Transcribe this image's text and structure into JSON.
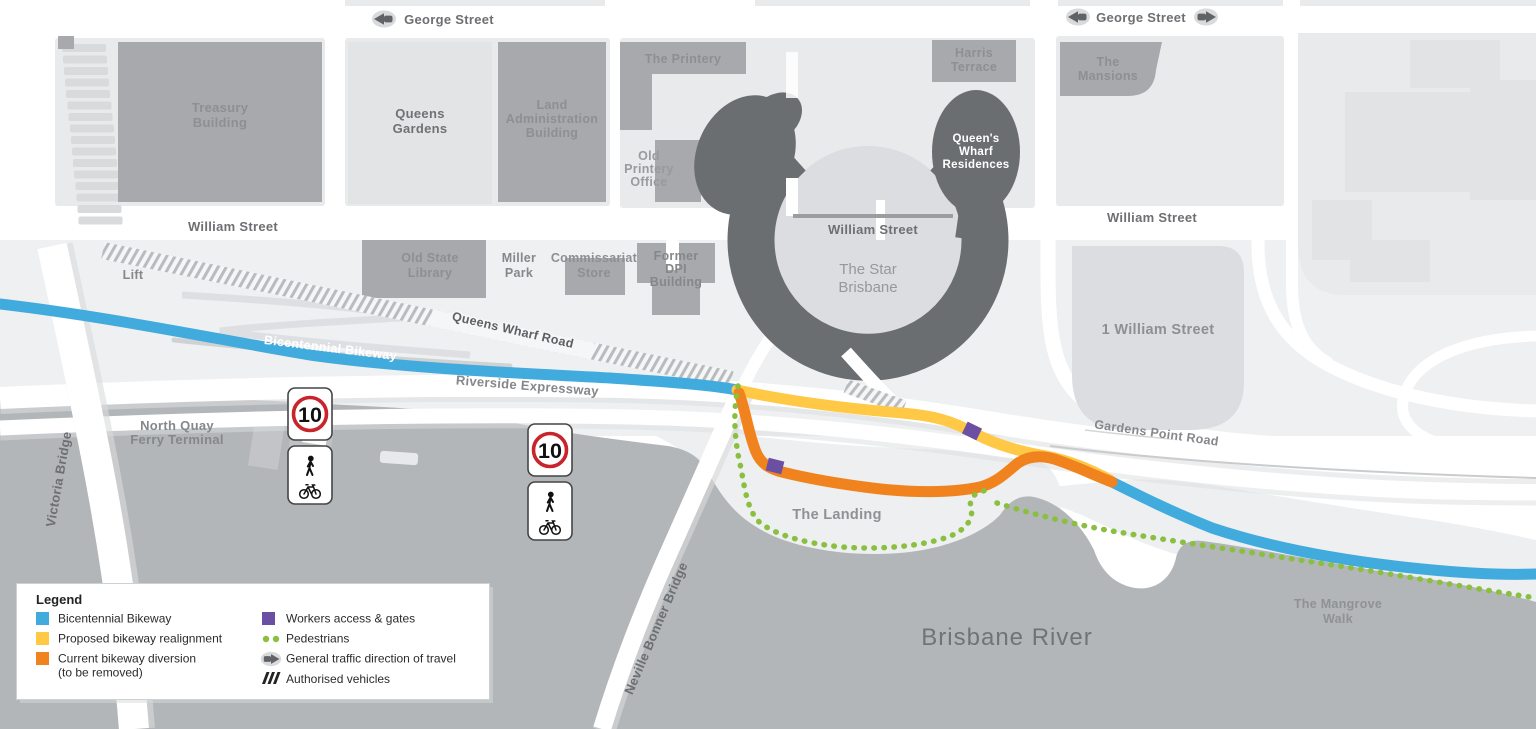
{
  "streets": {
    "george": "George Street",
    "william": "William Street",
    "queens_wharf_road": "Queens Wharf Road",
    "riverside_expressway": "Riverside Expressway",
    "gardens_point_road": "Gardens Point Road",
    "victoria_bridge": "Victoria Bridge",
    "neville_bonner_bridge": "Neville Bonner Bridge"
  },
  "routes": {
    "bicentennial_bikeway_label": "Bicentennial Bikeway"
  },
  "places": {
    "treasury": [
      "Treasury",
      "Building"
    ],
    "queens_gardens": [
      "Queens",
      "Gardens"
    ],
    "land_administration": [
      "Land",
      "Administration",
      "Building"
    ],
    "the_printery": [
      "The Printery"
    ],
    "old_printery_office": [
      "Old",
      "Printery",
      "Office"
    ],
    "harris_terrace": [
      "Harris",
      "Terrace"
    ],
    "queens_wharf_residences": [
      "Queen's",
      "Wharf",
      "Residences"
    ],
    "the_star": [
      "The Star",
      "Brisbane"
    ],
    "the_mansions": [
      "The",
      "Mansions"
    ],
    "one_william_street": [
      "1 William Street"
    ],
    "old_state_library": [
      "Old State",
      "Library"
    ],
    "miller_park": [
      "Miller",
      "Park"
    ],
    "commissariat_store": [
      "Commissariat",
      "Store"
    ],
    "former_dpi": [
      "Former",
      "DPI",
      "Building"
    ],
    "lift": [
      "Lift"
    ],
    "north_quay_ferry": [
      "North Quay",
      "Ferry Terminal"
    ],
    "the_landing": [
      "The Landing"
    ],
    "mangrove_walk": [
      "The Mangrove",
      "Walk"
    ],
    "brisbane_river": [
      "Brisbane River"
    ]
  },
  "signs": {
    "speed_limit": "10"
  },
  "legend": {
    "title": "Legend",
    "items": [
      {
        "label": "Bicentennial Bikeway",
        "swatch": "blue"
      },
      {
        "label": "Proposed bikeway realignment",
        "swatch": "yellow"
      },
      {
        "label": "Current bikeway diversion",
        "label2": "(to be removed)",
        "swatch": "orange"
      },
      {
        "label": "Workers access & gates",
        "swatch": "purple"
      },
      {
        "label": "Pedestrians",
        "swatch": "green-dots"
      },
      {
        "label": "General traffic direction of travel",
        "swatch": "arrow"
      },
      {
        "label": "Authorised vehicles",
        "swatch": "hatch"
      }
    ]
  },
  "colors": {
    "bikeway_blue": "#41abde",
    "realignment_yellow": "#ffc845",
    "diversion_orange": "#f0831e",
    "workers_purple": "#6a4fa2",
    "pedestrians_green": "#8abf3f",
    "speed_ring_red": "#c8242c"
  }
}
